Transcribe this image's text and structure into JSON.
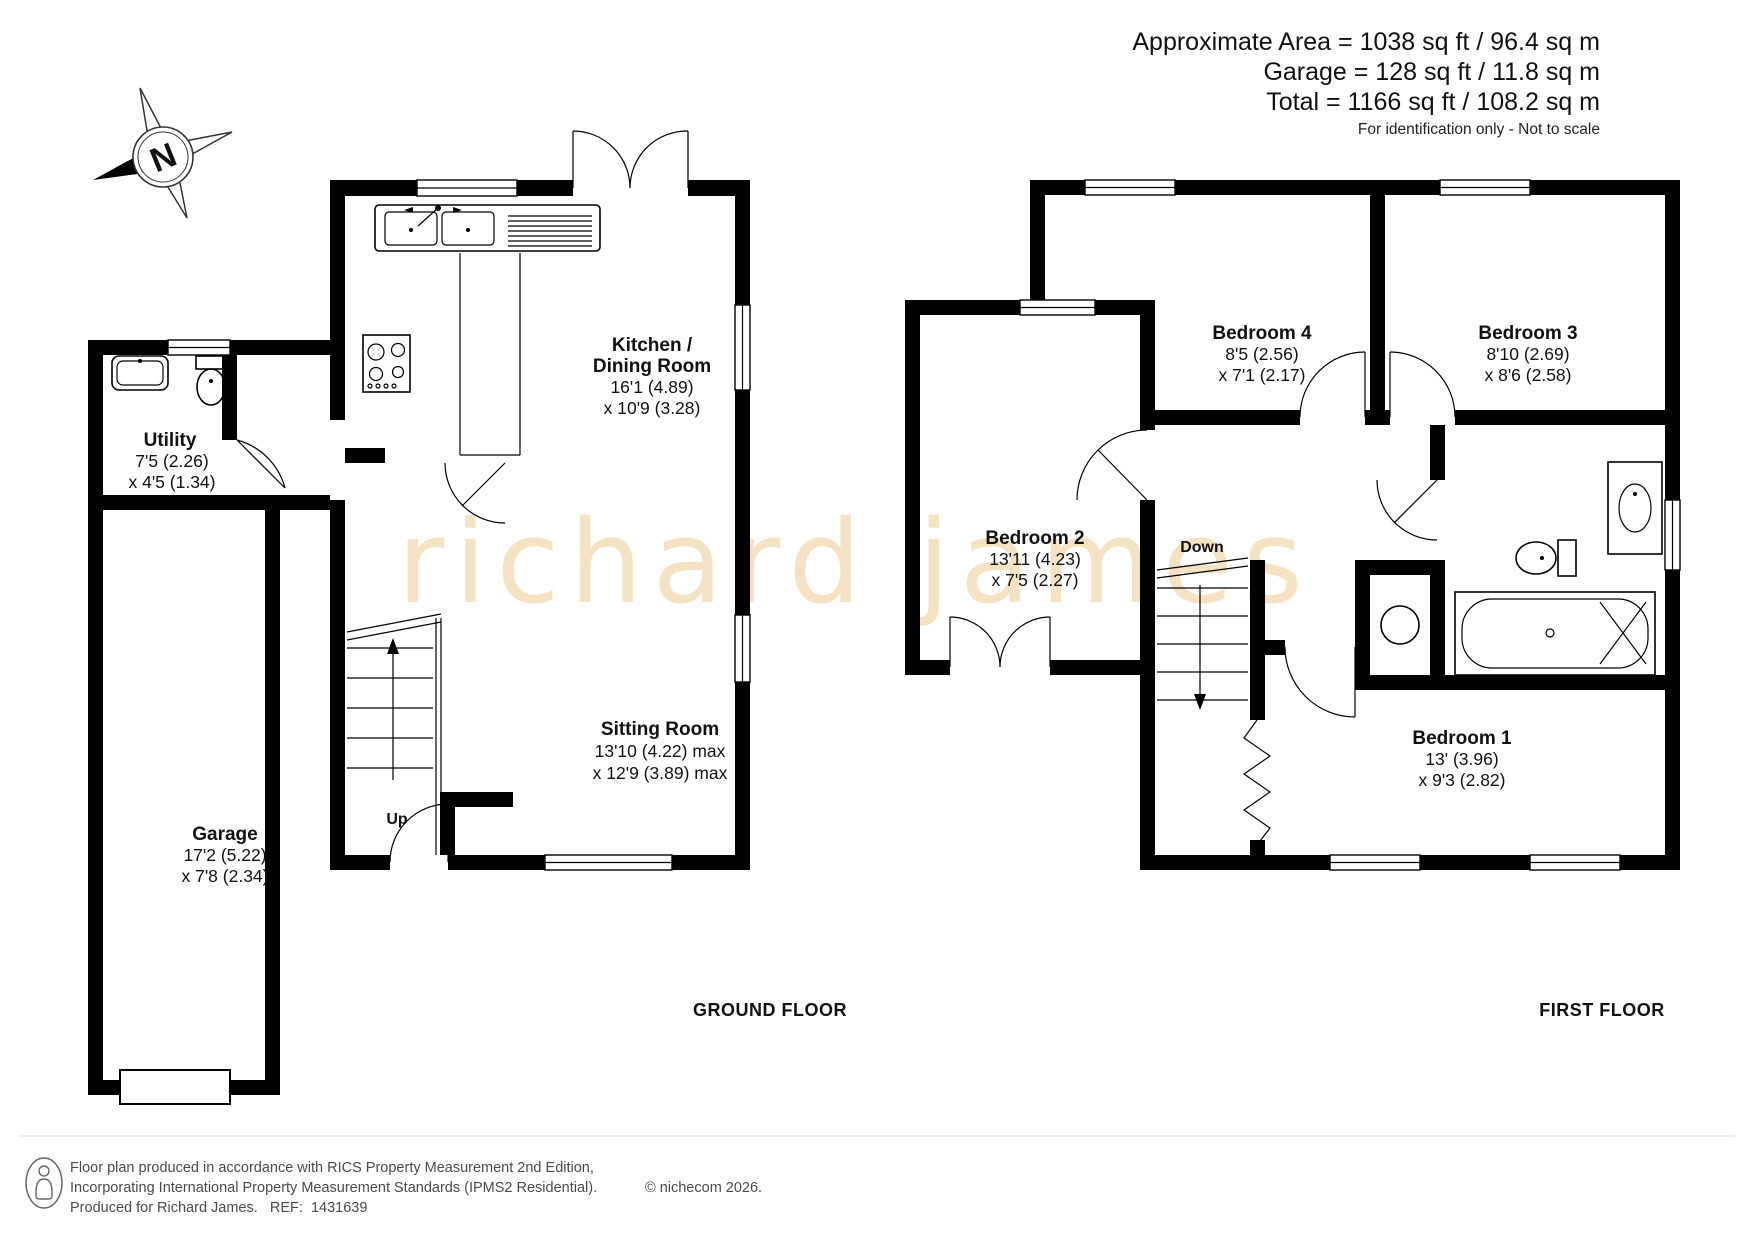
{
  "header": {
    "line1": "Approximate Area = 1038 sq ft / 96.4 sq m",
    "line2": "Garage = 128 sq ft / 11.8 sq m",
    "line3": "Total = 1166 sq ft / 108.2 sq m",
    "disclaimer": "For identification only - Not to scale"
  },
  "compass": {
    "north": "N"
  },
  "watermark": {
    "text": "richard james",
    "color": "#f5e2c3"
  },
  "ground_floor": {
    "title": "GROUND FLOOR",
    "stairs_label": "Up",
    "kitchen": {
      "line1": "Kitchen /",
      "line2": "Dining Room",
      "dim1": "16'1 (4.89)",
      "dim2": "x 10'9 (3.28)"
    },
    "sitting": {
      "name": "Sitting Room",
      "dim1": "13'10 (4.22) max",
      "dim2": "x 12'9 (3.89) max"
    },
    "utility": {
      "name": "Utility",
      "dim1": "7'5 (2.26)",
      "dim2": "x 4'5 (1.34)"
    },
    "garage": {
      "name": "Garage",
      "dim1": "17'2 (5.22)",
      "dim2": "x 7'8 (2.34)"
    }
  },
  "first_floor": {
    "title": "FIRST FLOOR",
    "stairs_label": "Down",
    "bedroom1": {
      "name": "Bedroom 1",
      "dim1": "13' (3.96)",
      "dim2": "x 9'3 (2.82)"
    },
    "bedroom2": {
      "name": "Bedroom 2",
      "dim1": "13'11 (4.23)",
      "dim2": "x 7'5 (2.27)"
    },
    "bedroom3": {
      "name": "Bedroom 3",
      "dim1": "8'10 (2.69)",
      "dim2": "x 8'6 (2.58)"
    },
    "bedroom4": {
      "name": "Bedroom 4",
      "dim1": "8'5 (2.56)",
      "dim2": "x 7'1 (2.17)"
    }
  },
  "footer": {
    "line1": "Floor plan produced in accordance with RICS Property Measurement 2nd Edition,",
    "line2": "Incorporating International Property Measurement Standards (IPMS2 Residential).",
    "copyright": "© nichecom 2026.",
    "line3": "Produced for Richard James.   REF:  1431639"
  }
}
